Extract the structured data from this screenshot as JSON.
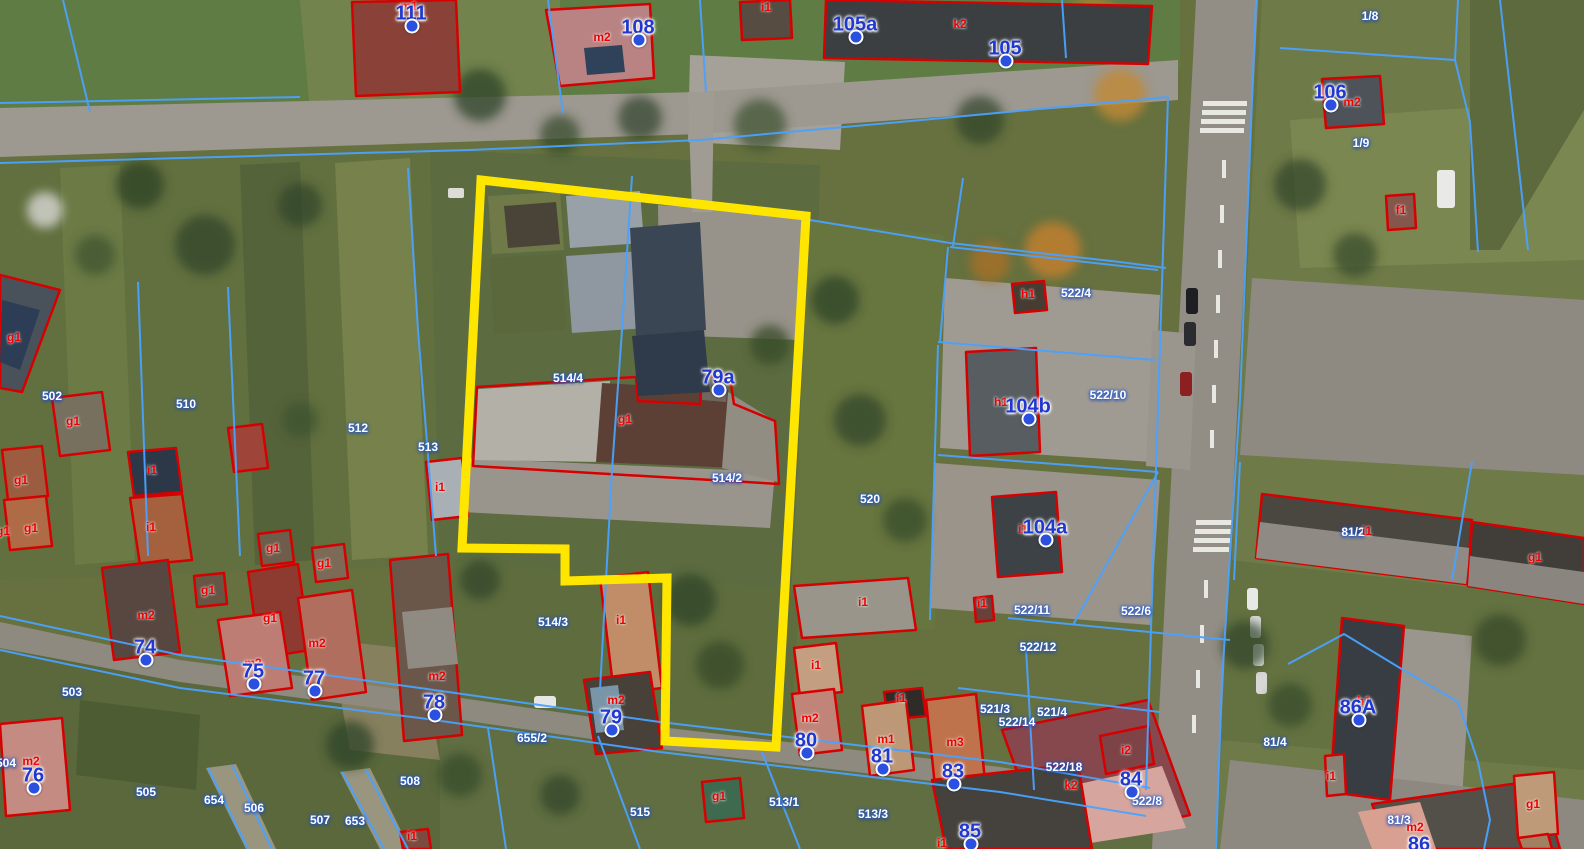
{
  "map": {
    "kind": "aerial-cadastral-view",
    "colors": {
      "highlight_outline": "#ffe600",
      "building_outline": "#d60000",
      "parcel_line": "#4aa2ff",
      "parcel_text": "#ffffff",
      "building_text": "#ef0000",
      "address_text": "#2038d0",
      "address_dot": "#2b50e0"
    }
  },
  "labels": {
    "parcels": [
      {
        "t": "1/8",
        "x": 1370,
        "y": 16
      },
      {
        "t": "1/9",
        "x": 1361,
        "y": 143
      },
      {
        "t": "502",
        "x": 52,
        "y": 396
      },
      {
        "t": "510",
        "x": 186,
        "y": 404
      },
      {
        "t": "512",
        "x": 358,
        "y": 428
      },
      {
        "t": "513",
        "x": 428,
        "y": 447
      },
      {
        "t": "514/4",
        "x": 568,
        "y": 378
      },
      {
        "t": "514/2",
        "x": 727,
        "y": 478
      },
      {
        "t": "514/3",
        "x": 553,
        "y": 622
      },
      {
        "t": "520",
        "x": 870,
        "y": 499
      },
      {
        "t": "522/4",
        "x": 1076,
        "y": 293
      },
      {
        "t": "522/10",
        "x": 1108,
        "y": 395
      },
      {
        "t": "522/11",
        "x": 1032,
        "y": 610
      },
      {
        "t": "522/6",
        "x": 1136,
        "y": 611
      },
      {
        "t": "522/12",
        "x": 1038,
        "y": 647
      },
      {
        "t": "521/3",
        "x": 995,
        "y": 709
      },
      {
        "t": "521/4",
        "x": 1052,
        "y": 712
      },
      {
        "t": "522/14",
        "x": 1017,
        "y": 722
      },
      {
        "t": "522/18",
        "x": 1064,
        "y": 767
      },
      {
        "t": "522/8",
        "x": 1147,
        "y": 801
      },
      {
        "t": "503",
        "x": 72,
        "y": 692
      },
      {
        "t": "504",
        "x": 6,
        "y": 763
      },
      {
        "t": "505",
        "x": 146,
        "y": 792
      },
      {
        "t": "654",
        "x": 214,
        "y": 800
      },
      {
        "t": "506",
        "x": 254,
        "y": 808
      },
      {
        "t": "507",
        "x": 320,
        "y": 820
      },
      {
        "t": "653",
        "x": 355,
        "y": 821
      },
      {
        "t": "508",
        "x": 410,
        "y": 781
      },
      {
        "t": "515",
        "x": 640,
        "y": 812
      },
      {
        "t": "655/2",
        "x": 532,
        "y": 738
      },
      {
        "t": "513/1",
        "x": 784,
        "y": 802
      },
      {
        "t": "513/3",
        "x": 873,
        "y": 814
      },
      {
        "t": "81/2",
        "x": 1353,
        "y": 532
      },
      {
        "t": "81/4",
        "x": 1275,
        "y": 742
      },
      {
        "t": "81/3",
        "x": 1399,
        "y": 820
      }
    ],
    "addresses": [
      {
        "t": "111",
        "x": 411,
        "y": 14
      },
      {
        "t": "108",
        "x": 638,
        "y": 28
      },
      {
        "t": "105a",
        "x": 855,
        "y": 25
      },
      {
        "t": "105",
        "x": 1005,
        "y": 49
      },
      {
        "t": "106",
        "x": 1330,
        "y": 93
      },
      {
        "t": "79a",
        "x": 718,
        "y": 378
      },
      {
        "t": "104b",
        "x": 1028,
        "y": 407
      },
      {
        "t": "104a",
        "x": 1045,
        "y": 528
      },
      {
        "t": "74",
        "x": 145,
        "y": 648
      },
      {
        "t": "75",
        "x": 253,
        "y": 672
      },
      {
        "t": "77",
        "x": 314,
        "y": 679
      },
      {
        "t": "76",
        "x": 33,
        "y": 776
      },
      {
        "t": "78",
        "x": 434,
        "y": 703
      },
      {
        "t": "79",
        "x": 611,
        "y": 718
      },
      {
        "t": "80",
        "x": 806,
        "y": 741
      },
      {
        "t": "81",
        "x": 882,
        "y": 757
      },
      {
        "t": "83",
        "x": 953,
        "y": 772
      },
      {
        "t": "84",
        "x": 1131,
        "y": 780
      },
      {
        "t": "85",
        "x": 970,
        "y": 832
      },
      {
        "t": "86A",
        "x": 1358,
        "y": 708
      },
      {
        "t": "86",
        "x": 1419,
        "y": 845
      }
    ],
    "buildings": [
      {
        "t": "m1",
        "x": 409,
        "y": 6
      },
      {
        "t": "m2",
        "x": 602,
        "y": 37
      },
      {
        "t": "i1",
        "x": 766,
        "y": 7
      },
      {
        "t": "k2",
        "x": 960,
        "y": 24
      },
      {
        "t": "m2",
        "x": 1352,
        "y": 102
      },
      {
        "t": "f1",
        "x": 1401,
        "y": 210
      },
      {
        "t": "g1",
        "x": 14,
        "y": 337
      },
      {
        "t": "g1",
        "x": 73,
        "y": 421
      },
      {
        "t": "i1",
        "x": 152,
        "y": 470
      },
      {
        "t": "g1",
        "x": 21,
        "y": 480
      },
      {
        "t": "i1",
        "x": 151,
        "y": 527
      },
      {
        "t": "g1",
        "x": 31,
        "y": 528
      },
      {
        "t": "g1",
        "x": 3,
        "y": 531
      },
      {
        "t": "g1",
        "x": 273,
        "y": 548
      },
      {
        "t": "g1",
        "x": 324,
        "y": 563
      },
      {
        "t": "g1",
        "x": 208,
        "y": 590
      },
      {
        "t": "m2",
        "x": 146,
        "y": 615
      },
      {
        "t": "g1",
        "x": 270,
        "y": 618
      },
      {
        "t": "m2",
        "x": 317,
        "y": 643
      },
      {
        "t": "m2",
        "x": 253,
        "y": 663
      },
      {
        "t": "m2",
        "x": 437,
        "y": 676
      },
      {
        "t": "m2",
        "x": 31,
        "y": 761
      },
      {
        "t": "i1",
        "x": 621,
        "y": 620
      },
      {
        "t": "m2",
        "x": 616,
        "y": 700
      },
      {
        "t": "g1",
        "x": 625,
        "y": 419
      },
      {
        "t": "i1",
        "x": 440,
        "y": 487
      },
      {
        "t": "h1",
        "x": 1028,
        "y": 294
      },
      {
        "t": "h1",
        "x": 1001,
        "y": 402
      },
      {
        "t": "i1",
        "x": 1023,
        "y": 529
      },
      {
        "t": "i1",
        "x": 982,
        "y": 603
      },
      {
        "t": "i1",
        "x": 863,
        "y": 602
      },
      {
        "t": "i1",
        "x": 816,
        "y": 665
      },
      {
        "t": "m2",
        "x": 810,
        "y": 718
      },
      {
        "t": "f1",
        "x": 901,
        "y": 698
      },
      {
        "t": "m1",
        "x": 886,
        "y": 739
      },
      {
        "t": "m3",
        "x": 955,
        "y": 742
      },
      {
        "t": "k2",
        "x": 1071,
        "y": 785
      },
      {
        "t": "i2",
        "x": 1126,
        "y": 750
      },
      {
        "t": "i1",
        "x": 942,
        "y": 843
      },
      {
        "t": "h1",
        "x": 1364,
        "y": 701
      },
      {
        "t": "i1",
        "x": 1331,
        "y": 776
      },
      {
        "t": "m2",
        "x": 1415,
        "y": 827
      },
      {
        "t": "g1",
        "x": 1533,
        "y": 804
      },
      {
        "t": "g1",
        "x": 1535,
        "y": 557
      },
      {
        "t": "i1",
        "x": 1367,
        "y": 531
      },
      {
        "t": "g1",
        "x": 719,
        "y": 796
      },
      {
        "t": "i1",
        "x": 412,
        "y": 836
      }
    ]
  }
}
